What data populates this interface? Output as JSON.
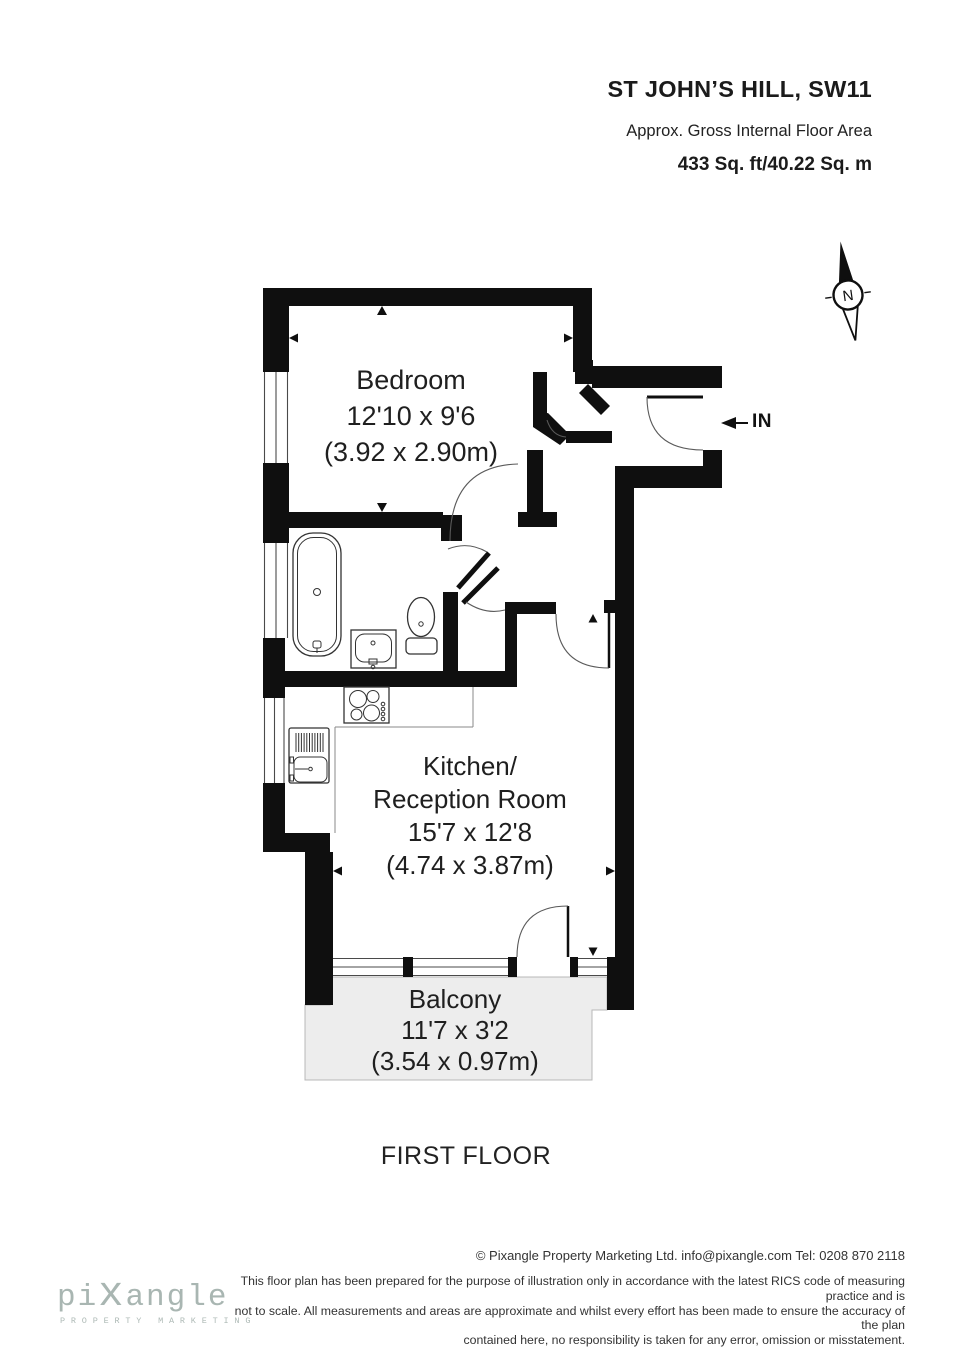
{
  "header": {
    "title": "ST JOHN’S HILL, SW11",
    "subtitle": "Approx. Gross Internal Floor Area",
    "area": "433 Sq. ft/40.22 Sq. m"
  },
  "compass": {
    "north_label": "N"
  },
  "entrance": {
    "label": "IN"
  },
  "rooms": {
    "bedroom": {
      "name": "Bedroom",
      "imperial": "12'10 x 9'6",
      "metric": "(3.92 x 2.90m)"
    },
    "kitchen": {
      "name_line1": "Kitchen/",
      "name_line2": "Reception Room",
      "imperial": "15'7 x 12'8",
      "metric": "(4.74 x 3.87m)"
    },
    "balcony": {
      "name": "Balcony",
      "imperial": "11'7 x 3'2",
      "metric": "(3.54 x 0.97m)"
    }
  },
  "floor": {
    "label": "FIRST FLOOR"
  },
  "footer": {
    "copyright": "© Pixangle Property Marketing Ltd. info@pixangle.com Tel: 0208 870 2118",
    "disclaimer_lines": [
      "This floor plan has been prepared for the purpose of illustration only in accordance with the latest RICS code of measuring practice and is",
      "not to scale. All measurements and areas are approximate and whilst every effort has been made to ensure the accuracy of the plan",
      "contained here, no responsibility is taken for any error, omission or misstatement."
    ],
    "logo": {
      "parts": [
        "pi",
        "x",
        "angle"
      ],
      "subtext": "PROPERTY MARKETING"
    }
  },
  "colors": {
    "wall": "#0f0f0f",
    "balcony_fill": "#ededed",
    "logo": "#a9b6b2"
  }
}
